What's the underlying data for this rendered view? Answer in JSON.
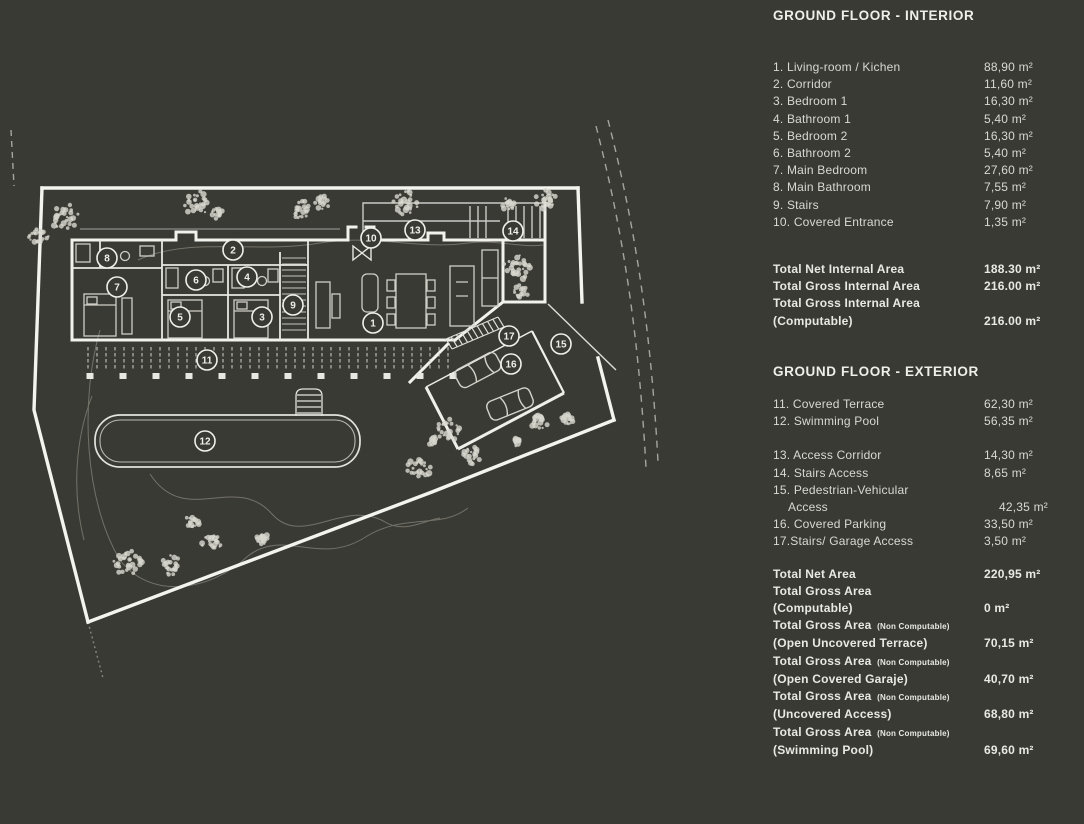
{
  "colors": {
    "background": "#3a3a35",
    "wall_line": "#f2f2ec",
    "thin_line": "#cfcfc8",
    "contour_line": "#85857b",
    "text": "#e3e3dd"
  },
  "panel": {
    "interior": {
      "title": "GROUND FLOOR - INTERIOR",
      "items": [
        {
          "label": "1. Living-room / Kichen",
          "value": "88,90 m²"
        },
        {
          "label": "2. Corridor",
          "value": "11,60 m²"
        },
        {
          "label": "3. Bedroom 1",
          "value": "16,30 m²"
        },
        {
          "label": "4. Bathroom 1",
          "value": "5,40 m²"
        },
        {
          "label": "5. Bedroom 2",
          "value": "16,30 m²"
        },
        {
          "label": "6. Bathroom 2",
          "value": "5,40 m²"
        },
        {
          "label": "7. Main Bedroom",
          "value": "27,60 m²"
        },
        {
          "label": "8. Main Bathroom",
          "value": "7,55 m²"
        },
        {
          "label": "9. Stairs",
          "value": "7,90 m²"
        },
        {
          "label": "10. Covered Entrance",
          "value": "1,35 m²"
        }
      ],
      "totals": [
        {
          "label": "Total Net Internal Area",
          "value": "188.30 m²"
        },
        {
          "label": "Total Gross Internal  Area",
          "value": "216.00 m²"
        },
        {
          "label": "Total Gross Internal Area",
          "value": ""
        },
        {
          "label": "(Computable)",
          "value": "216.00 m²"
        }
      ]
    },
    "exterior": {
      "title": "GROUND FLOOR - EXTERIOR",
      "items": [
        {
          "label": "11. Covered Terrace",
          "value": "62,30 m²"
        },
        {
          "label": "12. Swimming Pool",
          "value": "56,35 m²"
        },
        {
          "label": "",
          "value": ""
        },
        {
          "label": "13. Access Corridor",
          "value": "14,30 m²"
        },
        {
          "label": "14. Stairs Access",
          "value": "8,65 m²"
        },
        {
          "label": "15. Pedestrian-Vehicular",
          "value": ""
        },
        {
          "label": "Access",
          "value": "42,35 m²",
          "indent": true
        },
        {
          "label": "16. Covered Parking",
          "value": "33,50 m²"
        },
        {
          "label": "17.Stairs/ Garage Access",
          "value": "3,50 m²"
        }
      ],
      "totals": [
        {
          "label": "Total Net Area",
          "value": "220,95 m²"
        },
        {
          "label": "Total Gross Area",
          "value": ""
        },
        {
          "label": "(Computable)",
          "value": "0 m²"
        },
        {
          "label": "Total Gross Area ",
          "small": "(Non Computable)",
          "value": ""
        },
        {
          "label": "(Open Uncovered Terrace)",
          "value": "70,15 m²"
        },
        {
          "label": "Total Gross Area ",
          "small": "(Non Computable)",
          "value": ""
        },
        {
          "label": "(Open Covered Garaje)",
          "value": "40,70 m²"
        },
        {
          "label": "Total Gross Area ",
          "small": "(Non Computable)",
          "value": ""
        },
        {
          "label": "(Uncovered Access)",
          "value": "68,80 m²"
        },
        {
          "label": "Total Gross Area ",
          "small": "(Non Computable)",
          "value": ""
        },
        {
          "label": "(Swimming Pool)",
          "value": "69,60 m²"
        }
      ]
    }
  },
  "plan": {
    "bubbles": [
      {
        "n": "1",
        "x": 373,
        "y": 323
      },
      {
        "n": "2",
        "x": 233,
        "y": 250
      },
      {
        "n": "3",
        "x": 262,
        "y": 317
      },
      {
        "n": "4",
        "x": 247,
        "y": 277
      },
      {
        "n": "5",
        "x": 180,
        "y": 317
      },
      {
        "n": "6",
        "x": 196,
        "y": 280
      },
      {
        "n": "7",
        "x": 117,
        "y": 287
      },
      {
        "n": "8",
        "x": 107,
        "y": 258
      },
      {
        "n": "9",
        "x": 293,
        "y": 305
      },
      {
        "n": "10",
        "x": 371,
        "y": 238
      },
      {
        "n": "11",
        "x": 207,
        "y": 360
      },
      {
        "n": "12",
        "x": 205,
        "y": 441
      },
      {
        "n": "13",
        "x": 415,
        "y": 230
      },
      {
        "n": "14",
        "x": 513,
        "y": 231
      },
      {
        "n": "15",
        "x": 561,
        "y": 344
      },
      {
        "n": "16",
        "x": 511,
        "y": 364
      },
      {
        "n": "17",
        "x": 509,
        "y": 336
      }
    ],
    "trees": [
      [
        64,
        217,
        15
      ],
      [
        38,
        236,
        11
      ],
      [
        197,
        203,
        14
      ],
      [
        218,
        213,
        7
      ],
      [
        300,
        211,
        12
      ],
      [
        322,
        202,
        8
      ],
      [
        405,
        203,
        14
      ],
      [
        508,
        204,
        7
      ],
      [
        547,
        200,
        12
      ],
      [
        518,
        267,
        15
      ],
      [
        521,
        291,
        8
      ],
      [
        128,
        562,
        15
      ],
      [
        172,
        567,
        13
      ],
      [
        213,
        542,
        12
      ],
      [
        192,
        522,
        8
      ],
      [
        262,
        539,
        8
      ],
      [
        419,
        468,
        13
      ],
      [
        448,
        430,
        12
      ],
      [
        433,
        441,
        6
      ],
      [
        472,
        455,
        10
      ],
      [
        538,
        420,
        12
      ],
      [
        567,
        419,
        7
      ],
      [
        517,
        441,
        6
      ]
    ]
  }
}
